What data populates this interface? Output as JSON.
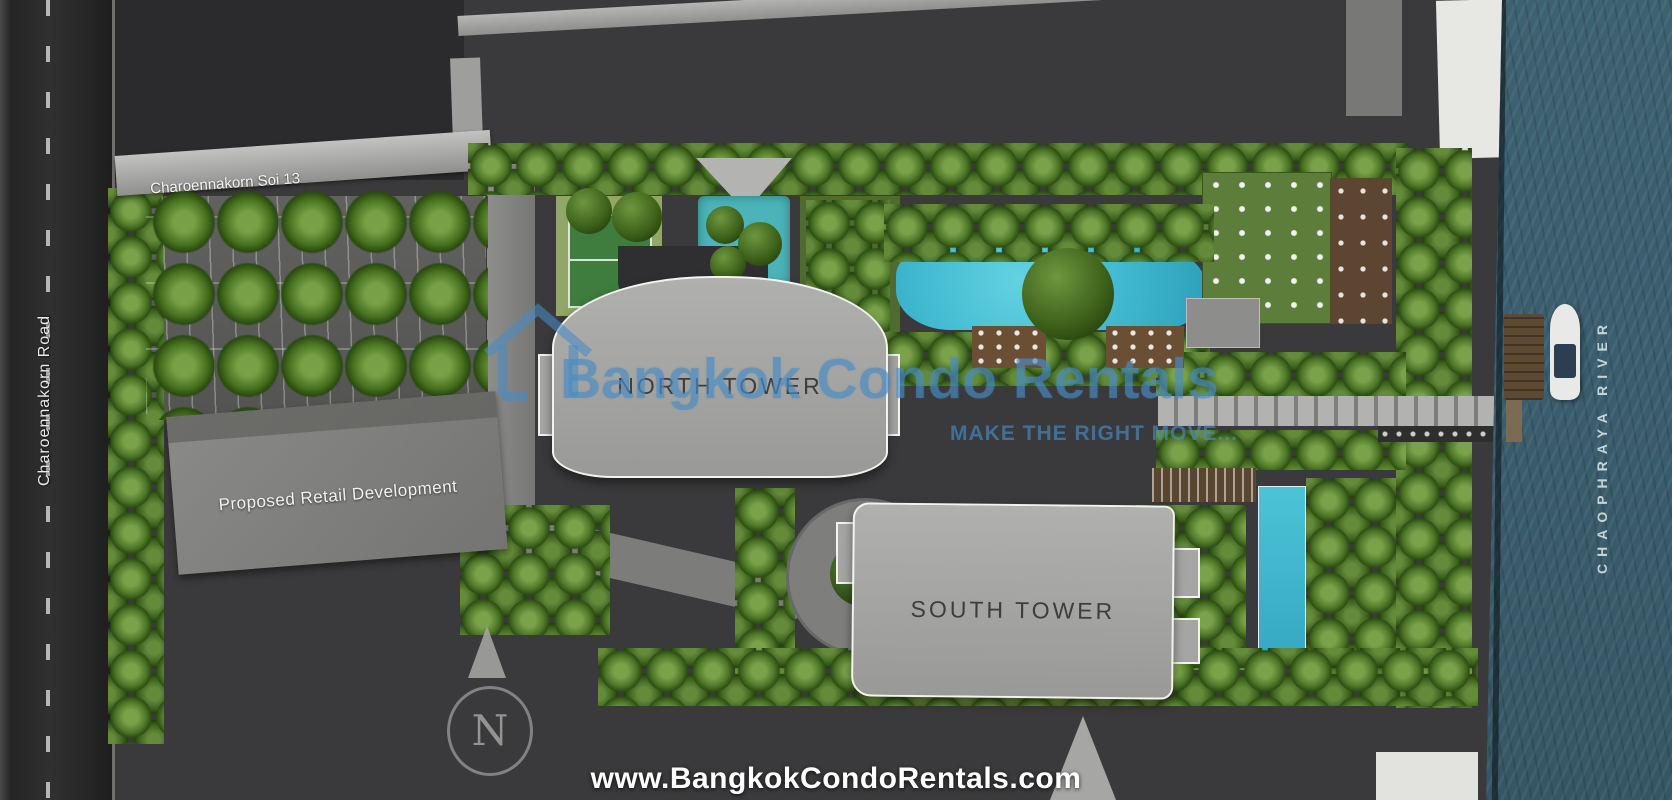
{
  "plan": {
    "roads": {
      "main": "Charoennakorn Road",
      "soi": "Charoennakorn Soi 13"
    },
    "buildings": {
      "north_tower": "NORTH TOWER",
      "south_tower": "SOUTH TOWER",
      "retail": "Proposed Retail Development"
    },
    "water": {
      "river": "CHAOPHRAYA RIVER"
    },
    "compass": {
      "letter": "N",
      "icon": "north-arrow-icon"
    }
  },
  "watermark": {
    "brand": "Bangkok Condo Rentals",
    "tagline": "MAKE THE RIGHT MOVE...",
    "logo_icon": "house-outline-icon",
    "color": "#488bc5"
  },
  "footer": {
    "url": "www.BangkokCondoRentals.com",
    "color": "#ffffff"
  },
  "icons": {
    "boat": "boat-icon",
    "pier": "pier-icon"
  },
  "colors": {
    "ground": "#3a3a3c",
    "river": "#3c6170",
    "pool": "#3fb8cf",
    "tower_footprint": "#a3a3a1",
    "internal_road": "#828280",
    "tree_green": "#4c7527",
    "deck_brown": "#6b4f35",
    "asphalt": "#2a2a2a"
  }
}
